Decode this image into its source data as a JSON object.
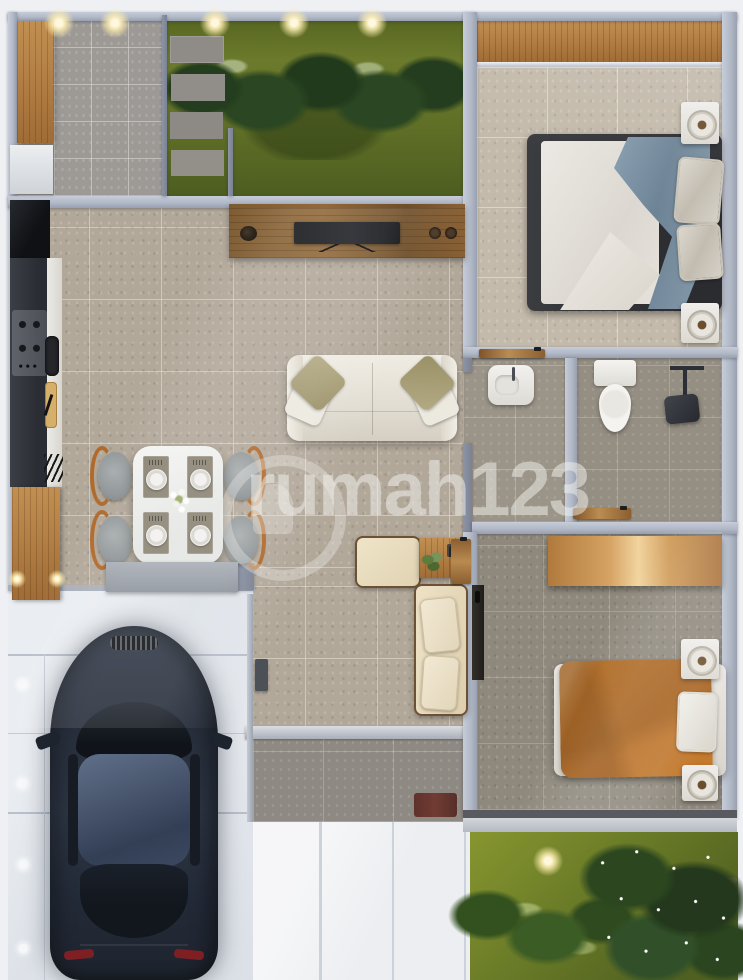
{
  "watermark": {
    "text": "rumah123"
  },
  "palette": {
    "outside": "#eef0f3",
    "wall": "#b2b9c7",
    "floorLiving": "#b2a89a",
    "floorBedroom1": "#c3baab",
    "floorBathroom": "#9b9488",
    "floorBedroom2": "#8f897d",
    "floorGarage": "#9d9a96",
    "floorPorch": "#8e8a83",
    "grass": "#66752a",
    "foliage": "#2f4a24",
    "woodLight": "#c89a5c",
    "woodConsole": "#7d5a30",
    "sofa": "#e6e2d9",
    "pillowOlive": "#a89f78",
    "blanketBlue": "#7b8fa0",
    "duvetOrange": "#c1792f",
    "carBody": "#272e3b",
    "driveway": "#e3e7ec",
    "walkway": "#eceef1",
    "watermarkColor": "rgba(244,243,239,0.5)"
  }
}
